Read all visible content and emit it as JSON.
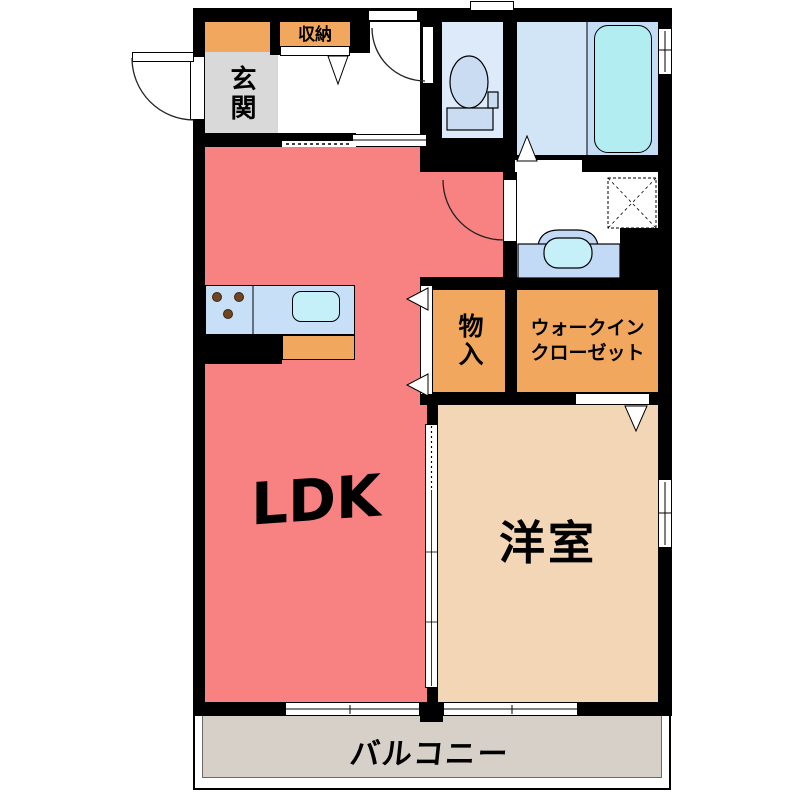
{
  "plan": {
    "title": "1LDK apartment floor plan",
    "rooms": {
      "ldk": {
        "label": "LDK",
        "color": "#F88181"
      },
      "western_room": {
        "label": "洋室",
        "color": "#F2D6B5"
      },
      "entrance": {
        "label": "玄関",
        "color": "#D9D9D9"
      },
      "hall_storage": {
        "label": "収納",
        "color": "#F1A75E"
      },
      "storage_closet": {
        "label": "物入",
        "color": "#F1A75E"
      },
      "walk_in_closet": {
        "label_line1": "ウォークイン",
        "label_line2": "クローゼット",
        "color": "#F1A75E"
      },
      "balcony": {
        "label": "バルコニー",
        "color": "#D7D0C9"
      },
      "toilet_room": {
        "color": "#DCEAF9"
      },
      "bathroom": {
        "color": "#D2E5F7"
      },
      "washroom": {
        "color": "#FFFFFF"
      }
    },
    "fixtures": {
      "toilet": "toilet-icon",
      "bathtub": "bathtub-icon",
      "washbasin": "washbasin-icon",
      "kitchen_sink": "sink-icon",
      "gas_stove": "stove-burners-icon",
      "washing_machine_space": "washing-machine-dashed-icon"
    },
    "colors": {
      "wall": "#000000",
      "bathtub": "#B2EDF2",
      "tub_panel": "#C5DCF5",
      "kitchen_counter": "#C8E0F7",
      "sink": "#C5F0F9",
      "washbasin_base": "#C2DAF5",
      "toilet_fixture": "#C9DCF2",
      "stove_dot": "#6F4522"
    }
  }
}
